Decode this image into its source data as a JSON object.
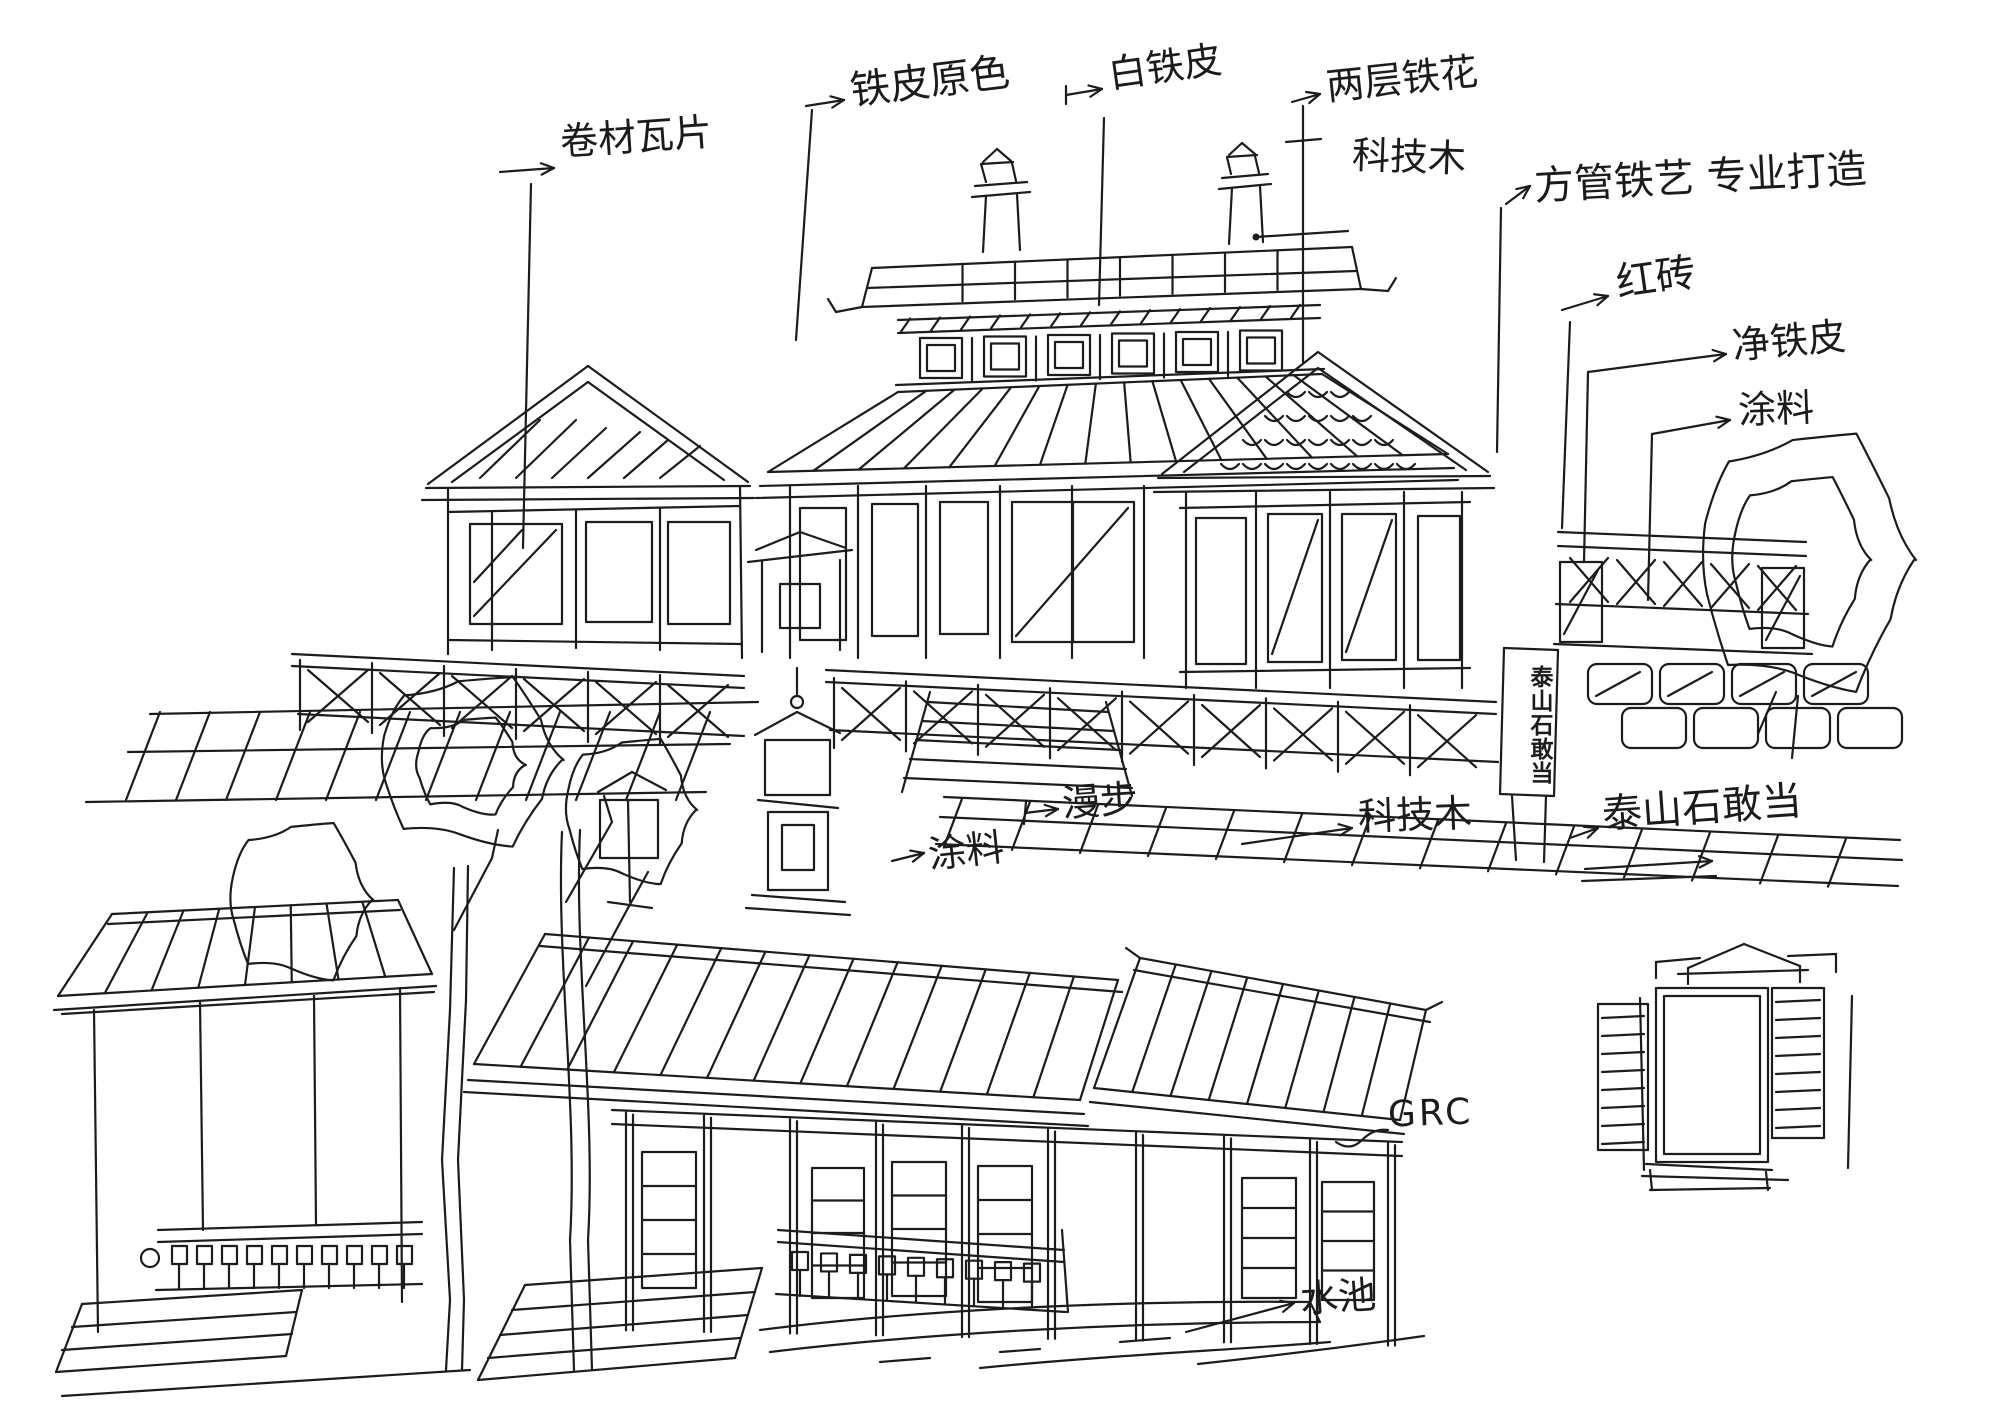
{
  "page": {
    "kind": "hand-drawn architectural concept sketch",
    "background_color": "#ffffff",
    "ink_color": "#1c1c1c"
  },
  "annotations": [
    {
      "id": "rolled-tile",
      "text": "卷材瓦片"
    },
    {
      "id": "iron-sheet-original",
      "text": "铁皮原色"
    },
    {
      "id": "white-iron-sheet",
      "text": "白铁皮"
    },
    {
      "id": "two-layer-iron-lattice",
      "text": "两层铁花"
    },
    {
      "id": "tech-wood-upper",
      "text": "科技木"
    },
    {
      "id": "square-tube-ironwork",
      "text": "方管铁艺 专业打造"
    },
    {
      "id": "red-brick",
      "text": "红砖"
    },
    {
      "id": "clean-iron-sheet",
      "text": "净铁皮"
    },
    {
      "id": "coating-right",
      "text": "涂料"
    },
    {
      "id": "stroll-path",
      "text": "漫步"
    },
    {
      "id": "coating-center",
      "text": "涂料"
    },
    {
      "id": "tech-wood-lower",
      "text": "科技木"
    },
    {
      "id": "taishan-stone",
      "text": "泰山石敢当"
    },
    {
      "id": "grc",
      "text": "GRC"
    },
    {
      "id": "water-pool",
      "text": "水池"
    }
  ],
  "sign": {
    "text": "泰山石敢当"
  }
}
